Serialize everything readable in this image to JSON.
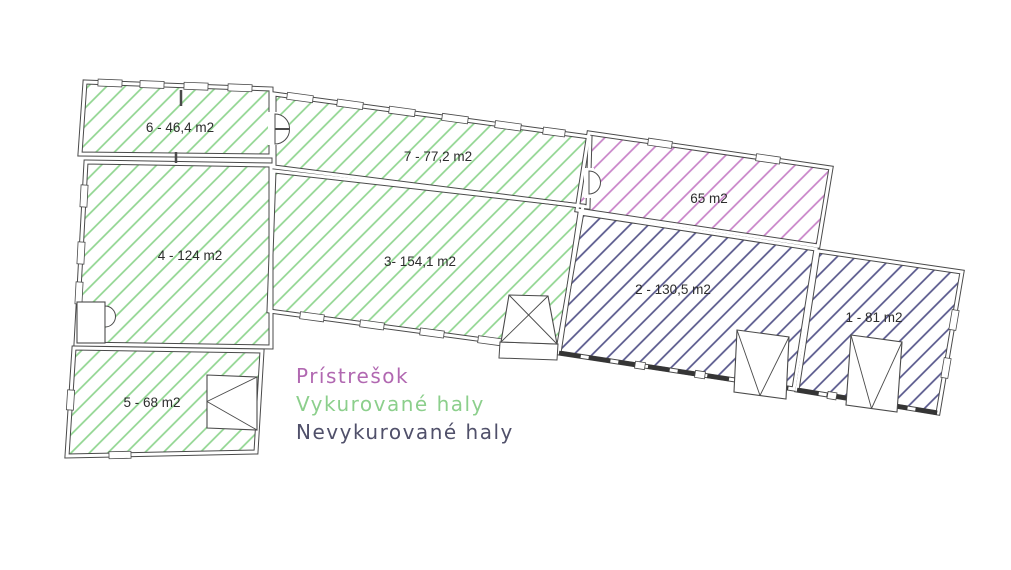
{
  "plan": {
    "background": "#ffffff",
    "wall_color": "#4a4a4a",
    "label_color": "#2d2d2d",
    "legend": [
      {
        "category": "shelter",
        "label": "Prístrešok"
      },
      {
        "category": "heated",
        "label": "Vykurované haly"
      },
      {
        "category": "unheated",
        "label": "Nevykurované haly"
      }
    ],
    "categories": {
      "shelter": {
        "hatch": "#c882c8",
        "text": "#b168b1",
        "spacing": 14
      },
      "heated": {
        "hatch": "#8fd58f",
        "text": "#8ccf8c",
        "spacing": 13
      },
      "unheated": {
        "hatch": "#55558a",
        "text": "#50506a",
        "spacing": 13
      }
    },
    "rooms": [
      {
        "id": "6",
        "label": "6 - 46,4 m2",
        "category": "heated",
        "polygon": [
          [
            85,
            82
          ],
          [
            271,
            89
          ],
          [
            271,
            156
          ],
          [
            80,
            154
          ]
        ],
        "label_pos": [
          180,
          128
        ]
      },
      {
        "id": "7",
        "label": "7 - 77,2 m2",
        "category": "heated",
        "polygon": [
          [
            274,
            94
          ],
          [
            590,
            137
          ],
          [
            588,
            207
          ],
          [
            274,
            167
          ]
        ],
        "label_pos": [
          438,
          157
        ]
      },
      {
        "id": "4",
        "label": "4 - 124 m2",
        "category": "heated",
        "polygon": [
          [
            86,
            162
          ],
          [
            271,
            165
          ],
          [
            271,
            347
          ],
          [
            76,
            344
          ]
        ],
        "label_pos": [
          190,
          256
        ]
      },
      {
        "id": "3",
        "label": "3- 154,1 m2",
        "category": "heated",
        "polygon": [
          [
            274,
            171
          ],
          [
            583,
            206
          ],
          [
            558,
            350
          ],
          [
            269,
            311
          ]
        ],
        "label_pos": [
          420,
          262
        ]
      },
      {
        "id": "5",
        "label": "5 - 68 m2",
        "category": "heated",
        "polygon": [
          [
            74,
            348
          ],
          [
            262,
            351
          ],
          [
            256,
            452
          ],
          [
            67,
            456
          ]
        ],
        "label_pos": [
          152,
          403
        ]
      },
      {
        "id": "shelter",
        "label": "65 m2",
        "category": "shelter",
        "polygon": [
          [
            589,
            133
          ],
          [
            831,
            168
          ],
          [
            818,
            246
          ],
          [
            577,
            210
          ]
        ],
        "label_pos": [
          709,
          199
        ]
      },
      {
        "id": "2",
        "label": "2 - 130,5 m2",
        "category": "unheated",
        "polygon": [
          [
            580,
            213
          ],
          [
            816,
            249
          ],
          [
            794,
            389
          ],
          [
            559,
            353
          ]
        ],
        "label_pos": [
          673,
          290
        ]
      },
      {
        "id": "1",
        "label": "1 - 81 m2",
        "category": "unheated",
        "polygon": [
          [
            818,
            251
          ],
          [
            962,
            272
          ],
          [
            938,
            413
          ],
          [
            797,
            390
          ]
        ],
        "label_pos": [
          874,
          318
        ]
      }
    ],
    "windows": [
      [
        110,
        83,
        24,
        2.2
      ],
      [
        152,
        84.5,
        24,
        2.2
      ],
      [
        196,
        86.2,
        24,
        2.2
      ],
      [
        240,
        87.8,
        24,
        2.2
      ],
      [
        300,
        97.5,
        26,
        7.75
      ],
      [
        350,
        104.3,
        26,
        7.75
      ],
      [
        402,
        111.4,
        26,
        7.75
      ],
      [
        455,
        118.6,
        26,
        7.75
      ],
      [
        508,
        125.8,
        26,
        7.75
      ],
      [
        554,
        132,
        22,
        7.75
      ],
      [
        660,
        143.3,
        24,
        8.2
      ],
      [
        768,
        158.9,
        24,
        8.2
      ],
      [
        84,
        196,
        22,
        93
      ],
      [
        81,
        253,
        22,
        93
      ],
      [
        79,
        293,
        22,
        93
      ],
      [
        70.5,
        400,
        20,
        93.7
      ],
      [
        120,
        455,
        22,
        -1.2
      ],
      [
        312,
        316.8,
        24,
        7.7
      ],
      [
        372,
        324.9,
        24,
        7.7
      ],
      [
        432,
        333,
        24,
        7.7
      ],
      [
        490,
        340.8,
        24,
        7.7
      ],
      [
        954,
        320,
        20,
        99.7
      ],
      [
        946,
        368,
        20,
        99.7
      ],
      [
        640,
        365.4,
        10,
        8.7
      ],
      [
        700,
        374.6,
        10,
        8.7
      ],
      [
        752,
        382.6,
        10,
        8.7
      ],
      [
        832,
        395.7,
        9,
        9.3
      ],
      [
        882,
        403.9,
        9,
        9.3
      ]
    ],
    "thick_walls": [
      [
        [
          559,
          353
        ],
        [
          794,
          389
        ]
      ],
      [
        [
          797,
          390
        ],
        [
          938,
          413
        ]
      ]
    ],
    "gates": [
      {
        "id": "gate-room3",
        "quad": [
          [
            509,
            295
          ],
          [
            548,
            296
          ],
          [
            557,
            344
          ],
          [
            501,
            342
          ]
        ],
        "fold": "x",
        "ext": [
          [
            500,
            342
          ],
          [
            558,
            344
          ],
          [
            557,
            360
          ],
          [
            499,
            358
          ]
        ]
      },
      {
        "id": "gate-room2",
        "quad": [
          [
            737,
            330
          ],
          [
            789,
            337
          ],
          [
            786,
            399
          ],
          [
            734,
            392
          ]
        ],
        "fold": "v"
      },
      {
        "id": "gate-room1",
        "quad": [
          [
            851,
            335
          ],
          [
            902,
            342
          ],
          [
            897,
            412
          ],
          [
            846,
            405
          ]
        ],
        "fold": "v"
      },
      {
        "id": "gate-room5",
        "quad": [
          [
            207,
            375
          ],
          [
            257,
            377
          ],
          [
            257,
            430
          ],
          [
            207,
            428
          ]
        ],
        "fold": "left"
      }
    ],
    "doors": [
      {
        "id": "door-room6",
        "gap": [
          268,
          112,
          9,
          33
        ],
        "paths": [
          "M 275 114 A 14.5 14.5 0 0 1 289.5 128.5 L 275 128.5 Z",
          "M 275 144 A 14.5 14.5 0 0 0 289.5 129.5 L 275 129.5 Z"
        ]
      },
      {
        "id": "door-shelter",
        "gap": [
          584,
          168,
          10,
          30
        ],
        "paths": [
          "M 589 171 A 11.5 11.5 0 0 1 589 194 L 589 171 Z"
        ]
      },
      {
        "id": "door-room4",
        "rect": [
          77,
          302,
          28,
          41
        ],
        "paths": [
          "M 105 306 A 10.5 10.5 0 0 1 105 327 L 105 306 Z"
        ]
      }
    ],
    "stubs": [
      [
        [
          181,
          90
        ],
        [
          181,
          106
        ]
      ],
      [
        [
          176,
          152
        ],
        [
          176,
          163
        ]
      ]
    ]
  }
}
